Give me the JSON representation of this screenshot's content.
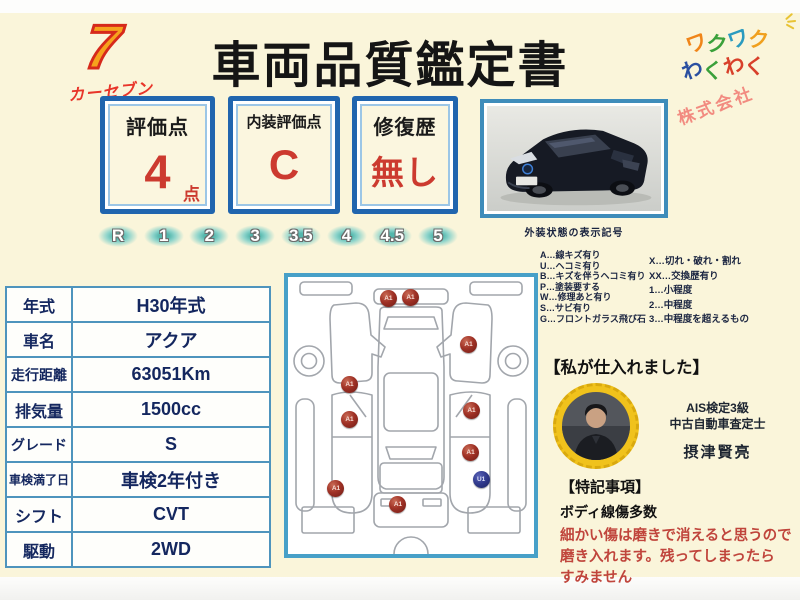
{
  "colors": {
    "background": "#FAF5DA",
    "accent_blue": "#2065AE",
    "table_border": "#4E94BD",
    "value_red": "#CC3A2F",
    "note_red": "#C0453C",
    "navy_text": "#14275F",
    "scale_teal": "#54B7AD",
    "diagram_frame_blue": "#47A0C8",
    "badge_yellow": "#F0C21C"
  },
  "header": {
    "logo_seven": "7",
    "logo_brand": "カーセブン",
    "title": "車両品質鑑定書",
    "wakuwaku_rows": [
      [
        {
          "ch": "ワ",
          "color": "#F08519"
        },
        {
          "ch": "ク",
          "color": "#3AA03A"
        },
        {
          "ch": "ワ",
          "color": "#2A9BBF"
        },
        {
          "ch": "ク",
          "color": "#F0A01E"
        }
      ],
      [
        {
          "ch": "わ",
          "color": "#2A4FA0"
        },
        {
          "ch": "く",
          "color": "#3AA03A"
        },
        {
          "ch": "わ",
          "color": "#D8402A"
        },
        {
          "ch": "く",
          "color": "#D8402A"
        }
      ]
    ],
    "company": "株式会社"
  },
  "score_boxes": [
    {
      "label": "評価点",
      "value": "4",
      "suffix": "点"
    },
    {
      "label": "内装評価点",
      "value": "C",
      "suffix": ""
    },
    {
      "label": "修復歴",
      "value": "無し",
      "suffix": ""
    }
  ],
  "rating_scale": [
    "R",
    "1",
    "2",
    "3",
    "3.5",
    "4",
    "4.5",
    "5"
  ],
  "photo_caption": "外装状態の表示記号",
  "legend": {
    "left": [
      "A…線キズ有り",
      "U…ヘコミ有り",
      "B…キズを伴うヘコミ有り",
      "P…塗装要する",
      "W…修理あと有り",
      "S…サビ有り",
      "G…フロントガラス飛び石"
    ],
    "right": [
      "X…切れ・破れ・割れ",
      "XX…交換歴有り",
      "1…小程度",
      "2…中程度",
      "3…中程度を超えるもの"
    ]
  },
  "spec_table": {
    "rows": [
      {
        "label": "年式",
        "value": "H30年式"
      },
      {
        "label": "車名",
        "value": "アクア"
      },
      {
        "label": "走行距離",
        "value": "63051Km"
      },
      {
        "label": "排気量",
        "value": "1500cc"
      },
      {
        "label": "グレード",
        "value": "S"
      },
      {
        "label": "車検満了日",
        "value": "車検2年付き"
      },
      {
        "label": "シフト",
        "value": "CVT"
      },
      {
        "label": "駆動",
        "value": "2WD"
      }
    ]
  },
  "damage_markers": [
    {
      "label": "A1",
      "type": "red",
      "x": 40.6,
      "y": 7.7
    },
    {
      "label": "A1",
      "type": "red",
      "x": 49.6,
      "y": 7.4
    },
    {
      "label": "A1",
      "type": "red",
      "x": 73.2,
      "y": 24.2
    },
    {
      "label": "A1",
      "type": "red",
      "x": 24.8,
      "y": 38.6
    },
    {
      "label": "A1",
      "type": "red",
      "x": 74.4,
      "y": 48.1
    },
    {
      "label": "A1",
      "type": "red",
      "x": 24.8,
      "y": 51.2
    },
    {
      "label": "A1",
      "type": "red",
      "x": 74.0,
      "y": 63.2
    },
    {
      "label": "U1",
      "type": "blue",
      "x": 78.3,
      "y": 73.0
    },
    {
      "label": "A1",
      "type": "red",
      "x": 19.3,
      "y": 76.1
    },
    {
      "label": "A1",
      "type": "red",
      "x": 44.5,
      "y": 81.8
    }
  ],
  "buyer": {
    "heading": "【私が仕入れました】",
    "qualification_line1": "AIS検定3級",
    "qualification_line2": "中古自動車査定士",
    "name": "摂津賢亮"
  },
  "notes": {
    "heading": "【特記事項】",
    "subject": "ボディ線傷多数",
    "red_lines": [
      "細かい傷は磨きで消えると思うので",
      "磨き入れます。残ってしまったら",
      "すみません"
    ]
  }
}
